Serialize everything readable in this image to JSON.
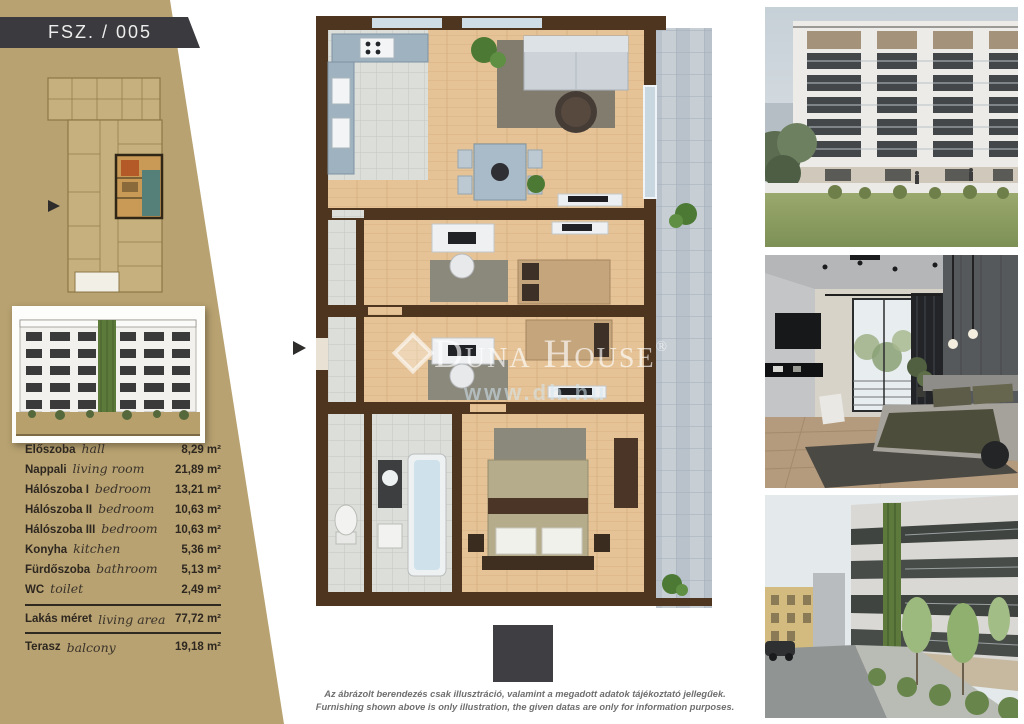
{
  "unit": {
    "label": "FSZ. / 005"
  },
  "rooms": [
    {
      "name_hu": "Előszoba",
      "name_en": "hall",
      "area": "8,29 m²"
    },
    {
      "name_hu": "Nappali",
      "name_en": "living room",
      "area": "21,89 m²"
    },
    {
      "name_hu": "Hálószoba I",
      "name_en": "bedroom",
      "area": "13,21 m²"
    },
    {
      "name_hu": "Hálószoba II",
      "name_en": "bedroom",
      "area": "10,63 m²"
    },
    {
      "name_hu": "Hálószoba III",
      "name_en": "bedroom",
      "area": "10,63 m²"
    },
    {
      "name_hu": "Konyha",
      "name_en": "kitchen",
      "area": "5,36 m²"
    },
    {
      "name_hu": "Fürdőszoba",
      "name_en": "bathroom",
      "area": "5,13 m²"
    },
    {
      "name_hu": "WC",
      "name_en": "toilet",
      "area": "2,49 m²"
    }
  ],
  "totals": [
    {
      "name_hu": "Lakás méret",
      "name_en": "living area",
      "area": "77,72 m²"
    },
    {
      "name_hu": "Terasz",
      "name_en": "balcony",
      "area": "19,18 m²"
    }
  ],
  "watermark": {
    "brand": "Duna House",
    "registered": "®",
    "url": "www.dh.hu"
  },
  "disclaimer": {
    "hu": "Az ábrázolt berendezés csak illusztráció, valamint a megadott adatok tájékoztató jellegűek.",
    "en": "Furnishing shown above is only illustration, the given datas are only for information purposes."
  },
  "colors": {
    "sidebar": "#b8a271",
    "header_box": "#3b3a3e",
    "wall": "#4d351f",
    "wood": "#e5c397",
    "tile": "#dcded9",
    "terrace_tile": "#b9c2ca",
    "greenery": "#4c7a34",
    "logo_square": "#3f3e43"
  }
}
